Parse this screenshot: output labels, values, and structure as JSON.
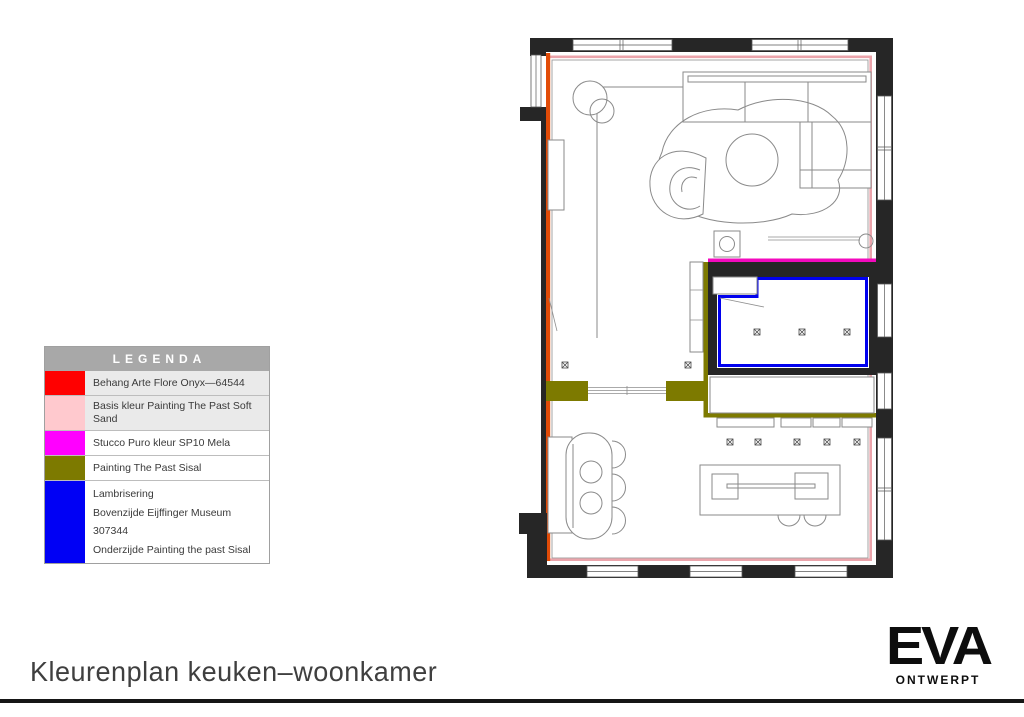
{
  "page": {
    "title": "Kleurenplan keuken–woonkamer"
  },
  "brand": {
    "name": "EVA",
    "tagline": "ONTWERPT"
  },
  "legend": {
    "title": "LEGENDA",
    "rows": [
      {
        "color": "#ff0000",
        "label": "Behang Arte Flore Onyx—64544"
      },
      {
        "color": "#ffc9ce",
        "label": "Basis kleur Painting The Past Soft Sand"
      },
      {
        "color": "#ff00ff",
        "label": "Stucco Puro kleur SP10 Mela"
      },
      {
        "color": "#7d7a00",
        "label": "Painting The Past Sisal"
      },
      {
        "color": "#0000f5",
        "label": "Lambrisering",
        "label2": "Bovenzijde Eijffinger Museum 307344",
        "label3": "Onderzijde Painting the past Sisal"
      }
    ]
  },
  "floor_plan": {
    "colors": {
      "wall": "#262626",
      "behang_red": "#e14b07",
      "soft_sand_pink": "#eba4ab",
      "stucco_magenta": "#f30abd",
      "sisal_olive": "#7d7a00",
      "lambrisering_blue": "#0101ee",
      "furniture_line": "#8a8a8a"
    }
  }
}
